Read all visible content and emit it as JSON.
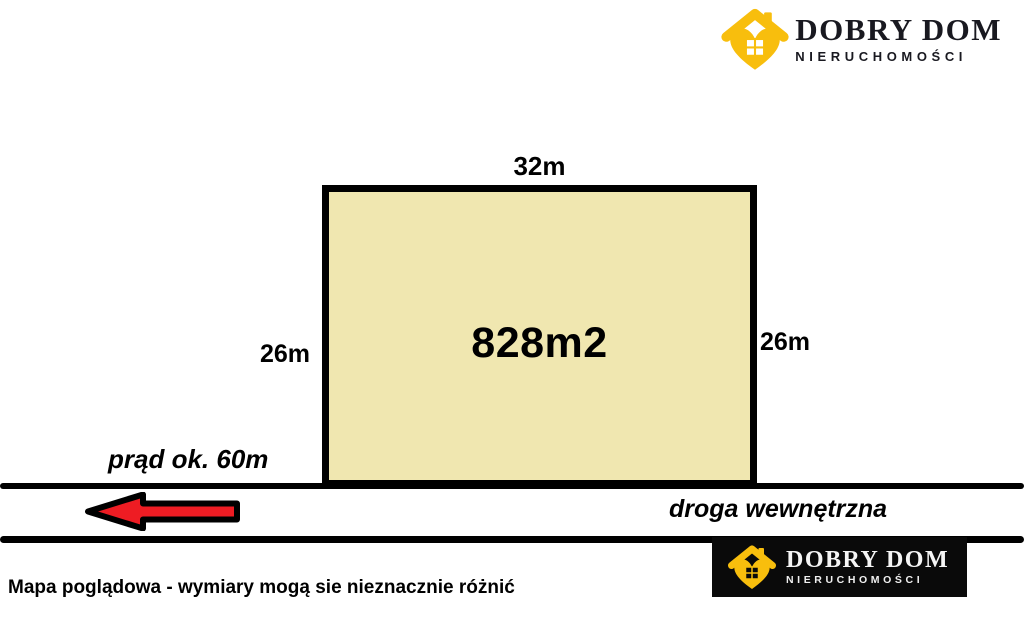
{
  "logo": {
    "title": "DOBRY DOM",
    "subtitle": "NIERUCHOMOŚCI"
  },
  "plot": {
    "area_label": "828m2",
    "width_label": "32m",
    "left_height_label": "26m",
    "right_height_label": "26m"
  },
  "annotations": {
    "power_line": "prąd ok. 60m",
    "road_name": "droga wewnętrzna",
    "disclaimer": "Mapa poglądowa - wymiary mogą sie nieznacznie różnić"
  },
  "icons": {
    "agency_icon": "house-heart-icon",
    "arrow_icon": "left-arrow-icon"
  },
  "colors": {
    "plot_fill": "#f0e7b0",
    "plot_border": "#000000",
    "arrow_red": "#ee1c23",
    "logo_gold": "#f8be0d",
    "logo_dark_text": "#191920",
    "logo_box_bg": "#0a0a0a"
  }
}
